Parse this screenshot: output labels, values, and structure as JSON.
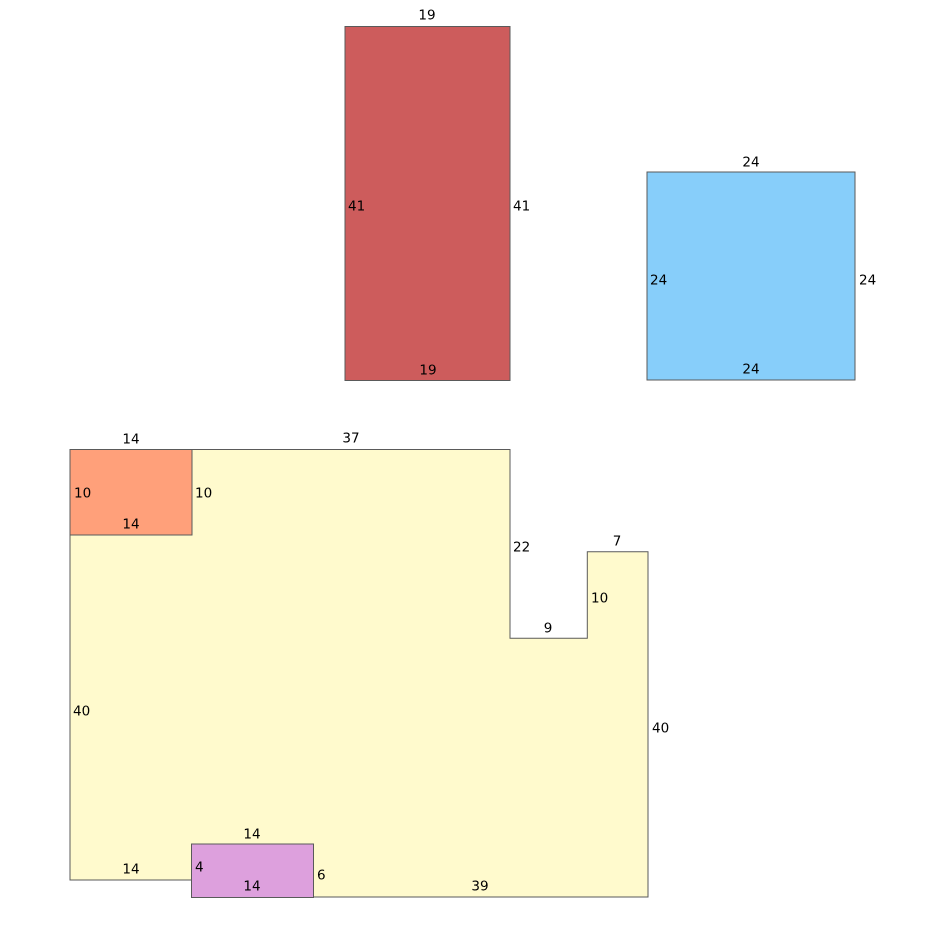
{
  "figure": {
    "background": "#ffffff",
    "edge_color": "#5a5a5a",
    "shapes": {
      "red_rectangle": {
        "fill": "#CD5C5C",
        "labels": {
          "top": "19",
          "left": "41",
          "right": "41",
          "bottom": "19"
        }
      },
      "blue_square": {
        "fill": "#87CEFA",
        "labels": {
          "top": "24",
          "left": "24",
          "right": "24",
          "bottom": "24"
        }
      },
      "yellow_polygon": {
        "fill": "#FFFACD",
        "labels": {
          "top": "37",
          "notch_left": "22",
          "notch_bottom": "9",
          "notch_right": "10",
          "upper_right_top": "7",
          "left": "40",
          "right": "40",
          "bottom_left": "14",
          "bottom": "39"
        }
      },
      "orange_rectangle": {
        "fill": "#FFA07A",
        "labels": {
          "top": "14",
          "left": "10",
          "right": "10",
          "bottom": "14"
        }
      },
      "purple_rectangle": {
        "fill": "#DDA0DD",
        "labels": {
          "top": "14",
          "left": "4",
          "right": "6",
          "bottom": "14"
        }
      }
    }
  }
}
